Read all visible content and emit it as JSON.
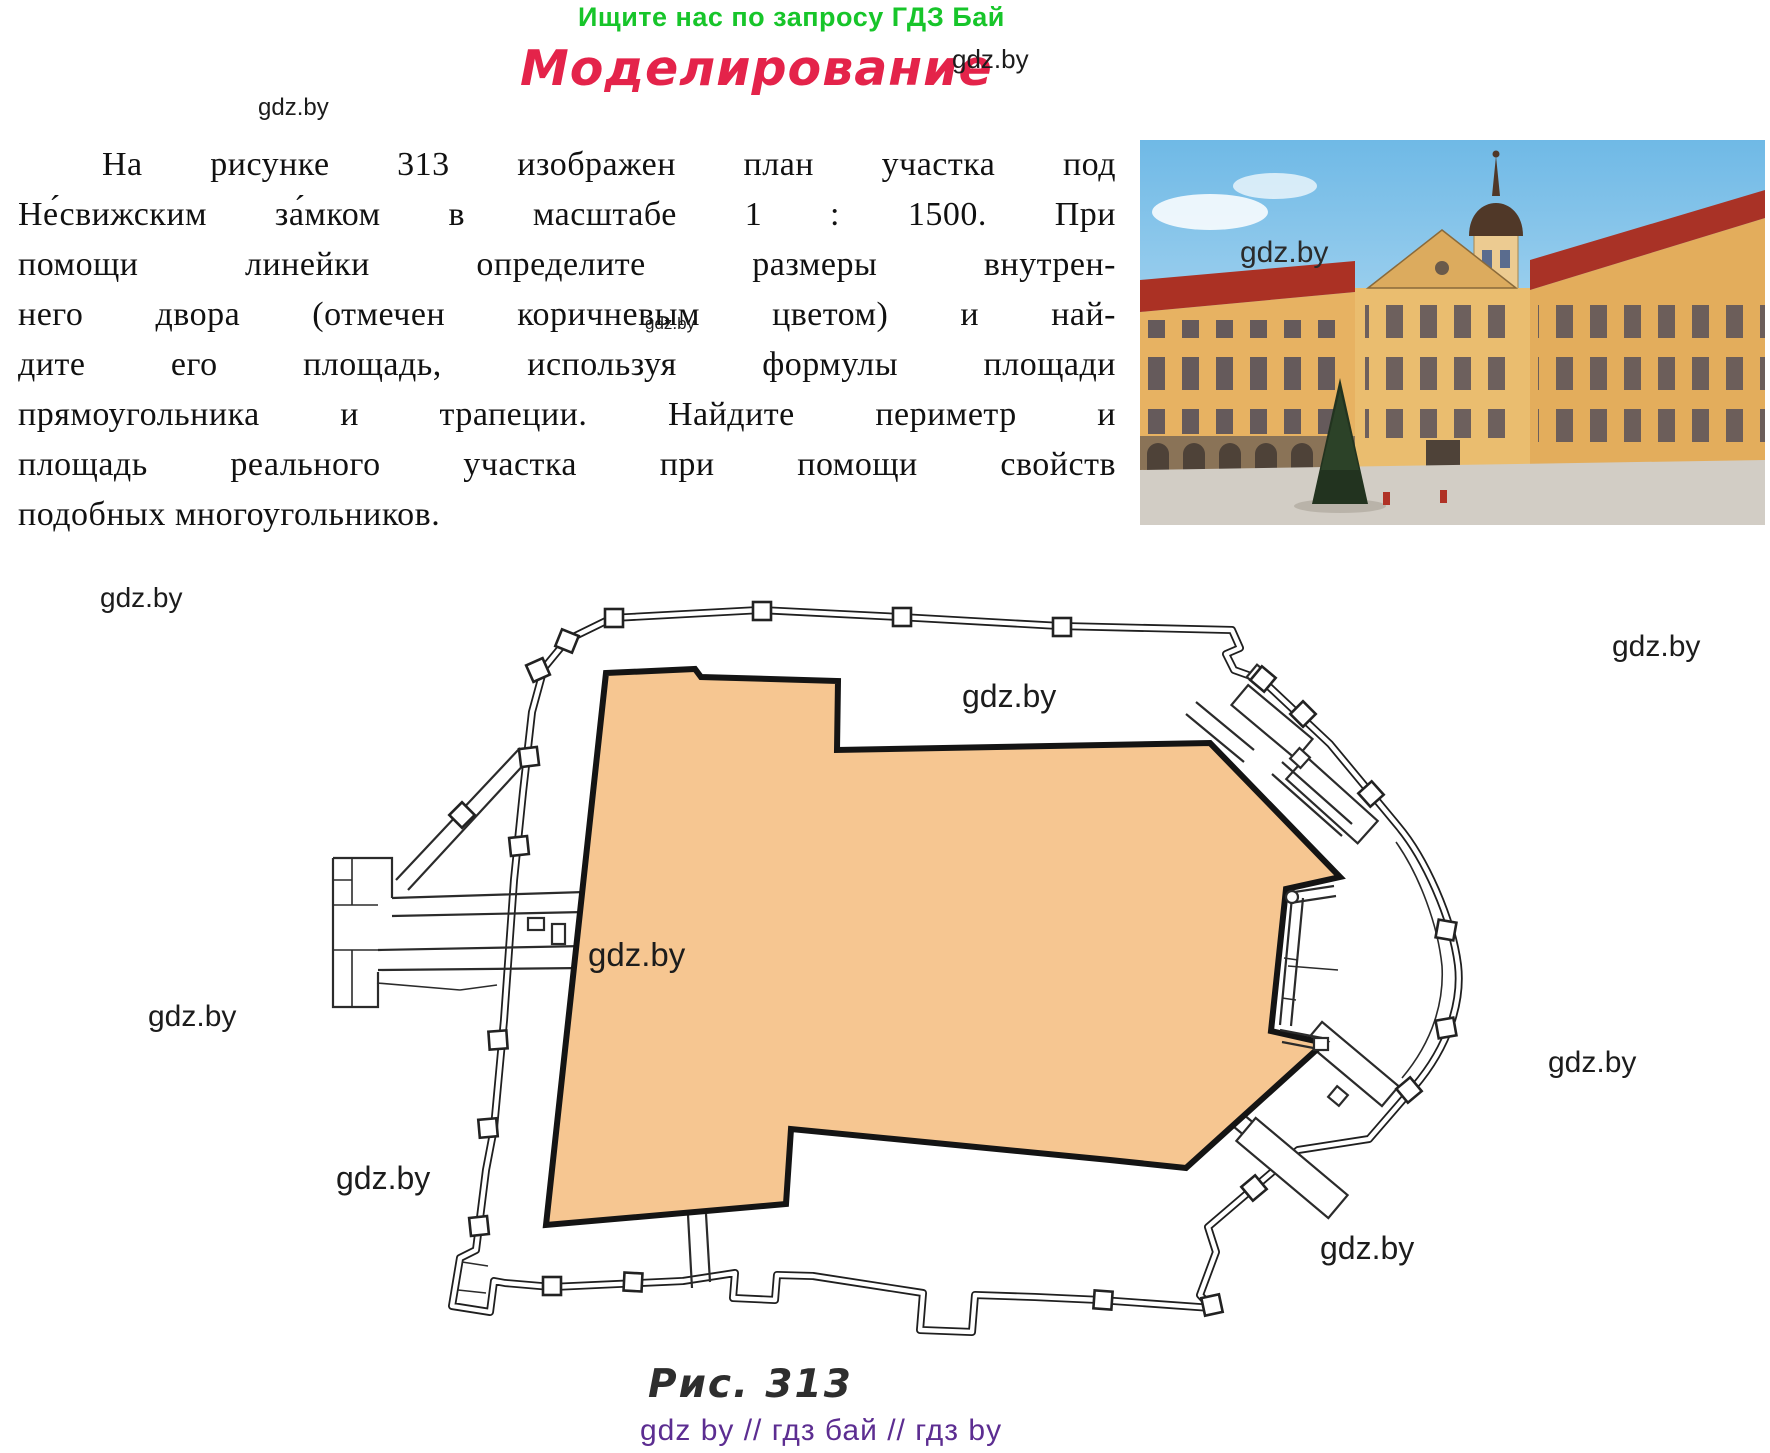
{
  "header": {
    "promo": "Ищите нас по запросу ГДЗ Бай",
    "title": "Моделирование"
  },
  "watermark": {
    "text": "gdz.by"
  },
  "paragraph": {
    "lines": [
      "На рисунке 313 изображен план участка под",
      "Не́свижским за́мком в масштабе 1 : 1500. При",
      "помощи линейки определите размеры внутрен-",
      "него двора (отмечен коричневым цветом) и най-",
      "дите его площадь, используя формулы площади",
      "прямоугольника и трапеции. Найдите периметр и",
      "площадь реального участка при помощи свойств",
      "подобных многоугольников."
    ]
  },
  "figure": {
    "caption": "Рис. 313",
    "courtyard_label": "внутренний двор",
    "scale_shown_in_text": "1 : 1500",
    "figure_number": "313"
  },
  "footer": {
    "text": "gdz by  //  гдз бай  //  гдз by"
  },
  "colors": {
    "promo_green": "#17C52A",
    "title_red": "#E4234A",
    "courtyard_fill": "#F6C691",
    "footer_purple": "#5C2D91",
    "plan_line": "#1f1f1f"
  }
}
